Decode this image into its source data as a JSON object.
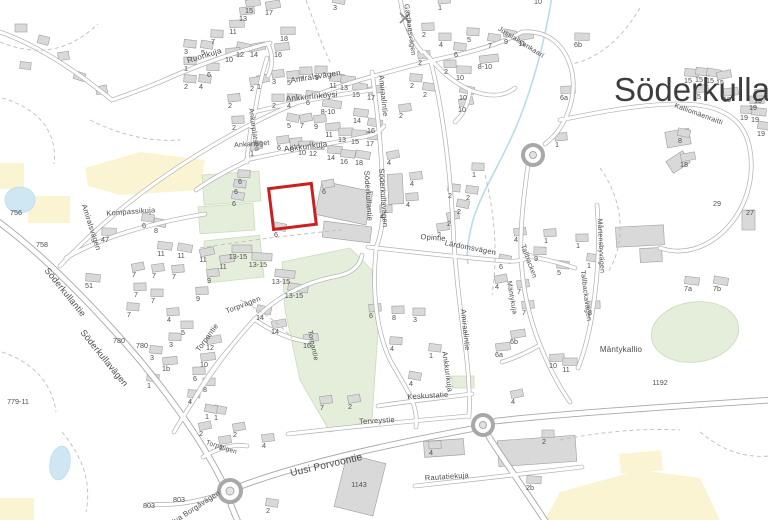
{
  "map": {
    "place_name": "Söderkulla",
    "colors": {
      "highlight": "#cc1f1f",
      "road_casing": "#b0b0b0",
      "road_fill": "#ffffff",
      "building": "#d9d9d9",
      "green_area": "#e4eedb",
      "yellow_area": "#faf4d3",
      "water": "#cfe7f2",
      "label_text": "#4a4a4a",
      "place_text": "#3d3d3d"
    },
    "street_labels": [
      {
        "t": "Ruorikuja",
        "x": 205,
        "y": 58,
        "r": -17,
        "s": 8
      },
      {
        "t": "Amiralsvägen",
        "x": 316,
        "y": 79,
        "r": -9,
        "s": 8
      },
      {
        "t": "Amiraalintie",
        "x": 381,
        "y": 96,
        "r": 84,
        "s": 7.5
      },
      {
        "t": "Ankkurinköysi",
        "x": 312,
        "y": 99,
        "r": -5,
        "s": 8
      },
      {
        "t": "Ankarplatsen",
        "x": 252,
        "y": 130,
        "r": 82,
        "s": 7
      },
      {
        "t": "Ankarlaget",
        "x": 252,
        "y": 146,
        "r": -4,
        "s": 7
      },
      {
        "t": "Ankkurikuja",
        "x": 306,
        "y": 149,
        "r": -7,
        "s": 8
      },
      {
        "t": "Gästhagsvägen",
        "x": 408,
        "y": 30,
        "r": 82,
        "s": 7
      },
      {
        "t": "Jusslaksenkaari",
        "x": 520,
        "y": 44,
        "r": 32,
        "s": 7
      },
      {
        "t": "Kalliomäenraitti",
        "x": 698,
        "y": 116,
        "r": 20,
        "s": 7
      },
      {
        "t": "Söderkullantie",
        "x": 366,
        "y": 196,
        "r": 86,
        "s": 7.5
      },
      {
        "t": "Söderkullavägen",
        "x": 381,
        "y": 198,
        "r": 86,
        "s": 7.5
      },
      {
        "t": "Opintie",
        "x": 433,
        "y": 240,
        "r": 4,
        "s": 7.5
      },
      {
        "t": "Lärdomsvägen",
        "x": 470,
        "y": 250,
        "r": 11,
        "s": 7.5
      },
      {
        "t": "Amiraalintie",
        "x": 463,
        "y": 330,
        "r": 84,
        "s": 7.5
      },
      {
        "t": "Ankkurikuja",
        "x": 445,
        "y": 372,
        "r": 82,
        "s": 7.5
      },
      {
        "t": "Kompassikuja",
        "x": 131,
        "y": 214,
        "r": -4,
        "s": 7.5
      },
      {
        "t": "Amiralsvägen",
        "x": 89,
        "y": 228,
        "r": 72,
        "s": 7.5
      },
      {
        "t": "Söderkullantie",
        "x": 63,
        "y": 294,
        "r": 51,
        "s": 9
      },
      {
        "t": "Söderkullavägen",
        "x": 102,
        "y": 360,
        "r": 51,
        "s": 9
      },
      {
        "t": "Torpvägen",
        "x": 244,
        "y": 307,
        "r": -21,
        "s": 7.5
      },
      {
        "t": "Torpantie",
        "x": 209,
        "y": 339,
        "r": -54,
        "s": 7.5
      },
      {
        "t": "Torpantie",
        "x": 311,
        "y": 346,
        "r": 78,
        "s": 7
      },
      {
        "t": "Torpstigen",
        "x": 221,
        "y": 449,
        "r": 18,
        "s": 6.5
      },
      {
        "t": "Keskustatie",
        "x": 428,
        "y": 398,
        "r": -3,
        "s": 7.5
      },
      {
        "t": "Terveystie",
        "x": 377,
        "y": 423,
        "r": -3,
        "s": 7.5
      },
      {
        "t": "Rautatiekuja",
        "x": 447,
        "y": 479,
        "r": -4,
        "s": 7.5
      },
      {
        "t": "Uusi Porvoontie",
        "x": 327,
        "y": 468,
        "r": -13,
        "s": 10
      },
      {
        "t": "Nya Borgåvägen",
        "x": 196,
        "y": 510,
        "r": -33,
        "s": 7.5
      },
      {
        "t": "Mårtensbyvägen",
        "x": 599,
        "y": 246,
        "r": 87,
        "s": 7
      },
      {
        "t": "Tallbackavägen",
        "x": 584,
        "y": 296,
        "r": 83,
        "s": 7
      },
      {
        "t": "Tallbacken",
        "x": 527,
        "y": 262,
        "r": 70,
        "s": 7
      },
      {
        "t": "Mäntykuja",
        "x": 510,
        "y": 298,
        "r": 80,
        "s": 7
      },
      {
        "t": "Mäntykallio",
        "x": 621,
        "y": 352,
        "r": 0,
        "s": 8
      }
    ],
    "house_numbers": [
      {
        "t": "15",
        "x": 249,
        "y": 13
      },
      {
        "t": "17",
        "x": 269,
        "y": 15
      },
      {
        "t": "13",
        "x": 243,
        "y": 21
      },
      {
        "t": "11",
        "x": 233,
        "y": 34
      },
      {
        "t": "18",
        "x": 284,
        "y": 41
      },
      {
        "t": "7",
        "x": 213,
        "y": 44
      },
      {
        "t": "3",
        "x": 186,
        "y": 54
      },
      {
        "t": "5",
        "x": 203,
        "y": 55
      },
      {
        "t": "12",
        "x": 240,
        "y": 57
      },
      {
        "t": "14",
        "x": 254,
        "y": 57
      },
      {
        "t": "16",
        "x": 278,
        "y": 57
      },
      {
        "t": "10",
        "x": 229,
        "y": 62
      },
      {
        "t": "1",
        "x": 186,
        "y": 71
      },
      {
        "t": "6",
        "x": 209,
        "y": 77
      },
      {
        "t": "2",
        "x": 186,
        "y": 89
      },
      {
        "t": "4",
        "x": 201,
        "y": 89
      },
      {
        "t": "3",
        "x": 335,
        "y": 10
      },
      {
        "t": "1",
        "x": 259,
        "y": 89
      },
      {
        "t": "3",
        "x": 274,
        "y": 84
      },
      {
        "t": "5",
        "x": 289,
        "y": 85
      },
      {
        "t": "7",
        "x": 302,
        "y": 81
      },
      {
        "t": "9",
        "x": 317,
        "y": 80
      },
      {
        "t": "11",
        "x": 333,
        "y": 88
      },
      {
        "t": "13",
        "x": 344,
        "y": 90
      },
      {
        "t": "15",
        "x": 356,
        "y": 97
      },
      {
        "t": "17",
        "x": 371,
        "y": 100
      },
      {
        "t": "2",
        "x": 252,
        "y": 91
      },
      {
        "t": "2",
        "x": 230,
        "y": 108
      },
      {
        "t": "2",
        "x": 234,
        "y": 130
      },
      {
        "t": "2",
        "x": 274,
        "y": 108
      },
      {
        "t": "4",
        "x": 289,
        "y": 108
      },
      {
        "t": "6",
        "x": 308,
        "y": 105
      },
      {
        "t": "8-10",
        "x": 328,
        "y": 114
      },
      {
        "t": "5",
        "x": 289,
        "y": 128
      },
      {
        "t": "7",
        "x": 302,
        "y": 128
      },
      {
        "t": "9",
        "x": 316,
        "y": 129
      },
      {
        "t": "11",
        "x": 329,
        "y": 137
      },
      {
        "t": "13",
        "x": 342,
        "y": 142
      },
      {
        "t": "15",
        "x": 355,
        "y": 144
      },
      {
        "t": "17",
        "x": 370,
        "y": 146
      },
      {
        "t": "14",
        "x": 357,
        "y": 123
      },
      {
        "t": "16",
        "x": 371,
        "y": 133
      },
      {
        "t": "1",
        "x": 252,
        "y": 156
      },
      {
        "t": "6",
        "x": 279,
        "y": 150
      },
      {
        "t": "8",
        "x": 292,
        "y": 152
      },
      {
        "t": "10",
        "x": 302,
        "y": 155
      },
      {
        "t": "12",
        "x": 313,
        "y": 156
      },
      {
        "t": "14",
        "x": 331,
        "y": 160
      },
      {
        "t": "16",
        "x": 344,
        "y": 164
      },
      {
        "t": "18",
        "x": 359,
        "y": 165
      },
      {
        "t": "4",
        "x": 389,
        "y": 165
      },
      {
        "t": "10",
        "x": 538,
        "y": 4
      },
      {
        "t": "1",
        "x": 440,
        "y": 10
      },
      {
        "t": "2",
        "x": 424,
        "y": 37
      },
      {
        "t": "4",
        "x": 441,
        "y": 47
      },
      {
        "t": "5",
        "x": 469,
        "y": 42
      },
      {
        "t": "6",
        "x": 456,
        "y": 57
      },
      {
        "t": "7",
        "x": 490,
        "y": 48
      },
      {
        "t": "9",
        "x": 506,
        "y": 44
      },
      {
        "t": "11",
        "x": 522,
        "y": 46
      },
      {
        "t": "8-10",
        "x": 485,
        "y": 69
      },
      {
        "t": "2",
        "x": 420,
        "y": 65
      },
      {
        "t": "2",
        "x": 446,
        "y": 74
      },
      {
        "t": "10",
        "x": 460,
        "y": 80
      },
      {
        "t": "2",
        "x": 412,
        "y": 88
      },
      {
        "t": "2",
        "x": 425,
        "y": 97
      },
      {
        "t": "10",
        "x": 463,
        "y": 100
      },
      {
        "t": "10",
        "x": 462,
        "y": 112
      },
      {
        "t": "2",
        "x": 401,
        "y": 118
      },
      {
        "t": "1",
        "x": 557,
        "y": 147
      },
      {
        "t": "6a",
        "x": 564,
        "y": 100
      },
      {
        "t": "6b",
        "x": 578,
        "y": 47
      },
      {
        "t": "15",
        "x": 688,
        "y": 83
      },
      {
        "t": "15",
        "x": 699,
        "y": 82
      },
      {
        "t": "15",
        "x": 710,
        "y": 83
      },
      {
        "t": "15",
        "x": 720,
        "y": 85
      },
      {
        "t": "15",
        "x": 697,
        "y": 99
      },
      {
        "t": "15",
        "x": 727,
        "y": 102
      },
      {
        "t": "19",
        "x": 758,
        "y": 103
      },
      {
        "t": "19",
        "x": 753,
        "y": 110
      },
      {
        "t": "19",
        "x": 744,
        "y": 120
      },
      {
        "t": "19",
        "x": 755,
        "y": 122
      },
      {
        "t": "19",
        "x": 761,
        "y": 136
      },
      {
        "t": "8",
        "x": 680,
        "y": 143
      },
      {
        "t": "18",
        "x": 684,
        "y": 167
      },
      {
        "t": "4",
        "x": 516,
        "y": 242
      },
      {
        "t": "1",
        "x": 546,
        "y": 243
      },
      {
        "t": "1",
        "x": 578,
        "y": 248
      },
      {
        "t": "9",
        "x": 536,
        "y": 261
      },
      {
        "t": "5",
        "x": 559,
        "y": 275
      },
      {
        "t": "1",
        "x": 589,
        "y": 268
      },
      {
        "t": "6",
        "x": 501,
        "y": 269
      },
      {
        "t": "4",
        "x": 497,
        "y": 289
      },
      {
        "t": "7",
        "x": 519,
        "y": 294
      },
      {
        "t": "7",
        "x": 524,
        "y": 315
      },
      {
        "t": "8",
        "x": 590,
        "y": 315
      },
      {
        "t": "29",
        "x": 717,
        "y": 206
      },
      {
        "t": "27",
        "x": 750,
        "y": 215
      },
      {
        "t": "7a",
        "x": 688,
        "y": 291
      },
      {
        "t": "7b",
        "x": 717,
        "y": 291
      },
      {
        "t": "1192",
        "x": 660,
        "y": 385
      },
      {
        "t": "6b",
        "x": 514,
        "y": 344
      },
      {
        "t": "6a",
        "x": 499,
        "y": 357
      },
      {
        "t": "10",
        "x": 553,
        "y": 368
      },
      {
        "t": "11",
        "x": 566,
        "y": 372
      },
      {
        "t": "6",
        "x": 240,
        "y": 184
      },
      {
        "t": "6",
        "x": 236,
        "y": 194
      },
      {
        "t": "6",
        "x": 234,
        "y": 206
      },
      {
        "t": "6",
        "x": 276,
        "y": 237
      },
      {
        "t": "6",
        "x": 324,
        "y": 194
      },
      {
        "t": "4",
        "x": 412,
        "y": 186
      },
      {
        "t": "4",
        "x": 408,
        "y": 207
      },
      {
        "t": "4",
        "x": 382,
        "y": 219
      },
      {
        "t": "1",
        "x": 474,
        "y": 177
      },
      {
        "t": "2",
        "x": 450,
        "y": 198
      },
      {
        "t": "2",
        "x": 468,
        "y": 200
      },
      {
        "t": "2",
        "x": 459,
        "y": 214
      },
      {
        "t": "2",
        "x": 449,
        "y": 226
      },
      {
        "t": "2",
        "x": 439,
        "y": 237
      },
      {
        "t": "6",
        "x": 371,
        "y": 318
      },
      {
        "t": "8",
        "x": 394,
        "y": 320
      },
      {
        "t": "3",
        "x": 415,
        "y": 322
      },
      {
        "t": "4",
        "x": 392,
        "y": 351
      },
      {
        "t": "1",
        "x": 431,
        "y": 358
      },
      {
        "t": "4",
        "x": 411,
        "y": 386
      },
      {
        "t": "4",
        "x": 513,
        "y": 404
      },
      {
        "t": "2",
        "x": 350,
        "y": 409
      },
      {
        "t": "7",
        "x": 322,
        "y": 410
      },
      {
        "t": "4",
        "x": 431,
        "y": 455
      },
      {
        "t": "2",
        "x": 544,
        "y": 444
      },
      {
        "t": "2b",
        "x": 530,
        "y": 490
      },
      {
        "t": "1143",
        "x": 359,
        "y": 487
      },
      {
        "t": "2",
        "x": 268,
        "y": 513
      },
      {
        "t": "1",
        "x": 216,
        "y": 420
      },
      {
        "t": "2",
        "x": 235,
        "y": 437
      },
      {
        "t": "4",
        "x": 264,
        "y": 448
      },
      {
        "t": "756",
        "x": 16,
        "y": 215
      },
      {
        "t": "758",
        "x": 42,
        "y": 247
      },
      {
        "t": "47",
        "x": 105,
        "y": 242
      },
      {
        "t": "51",
        "x": 89,
        "y": 288
      },
      {
        "t": "6",
        "x": 144,
        "y": 228
      },
      {
        "t": "8",
        "x": 156,
        "y": 233
      },
      {
        "t": "7",
        "x": 134,
        "y": 277
      },
      {
        "t": "7",
        "x": 154,
        "y": 278
      },
      {
        "t": "7",
        "x": 174,
        "y": 279
      },
      {
        "t": "7",
        "x": 136,
        "y": 297
      },
      {
        "t": "7",
        "x": 153,
        "y": 303
      },
      {
        "t": "7",
        "x": 129,
        "y": 317
      },
      {
        "t": "11",
        "x": 161,
        "y": 256
      },
      {
        "t": "11",
        "x": 181,
        "y": 258
      },
      {
        "t": "11",
        "x": 203,
        "y": 262
      },
      {
        "t": "11",
        "x": 223,
        "y": 269
      },
      {
        "t": "9",
        "x": 209,
        "y": 283
      },
      {
        "t": "9",
        "x": 198,
        "y": 301
      },
      {
        "t": "13-15",
        "x": 238,
        "y": 259
      },
      {
        "t": "13-15",
        "x": 258,
        "y": 267
      },
      {
        "t": "13-15",
        "x": 281,
        "y": 284
      },
      {
        "t": "13-15",
        "x": 294,
        "y": 298
      },
      {
        "t": "14",
        "x": 260,
        "y": 320
      },
      {
        "t": "14",
        "x": 275,
        "y": 334
      },
      {
        "t": "16",
        "x": 307,
        "y": 348
      },
      {
        "t": "4",
        "x": 169,
        "y": 322
      },
      {
        "t": "5",
        "x": 183,
        "y": 335
      },
      {
        "t": "3",
        "x": 171,
        "y": 347
      },
      {
        "t": "3",
        "x": 152,
        "y": 360
      },
      {
        "t": "780",
        "x": 119,
        "y": 343
      },
      {
        "t": "780",
        "x": 142,
        "y": 348
      },
      {
        "t": "12",
        "x": 210,
        "y": 350
      },
      {
        "t": "10",
        "x": 204,
        "y": 367
      },
      {
        "t": "1b",
        "x": 166,
        "y": 371
      },
      {
        "t": "6",
        "x": 195,
        "y": 381
      },
      {
        "t": "8",
        "x": 205,
        "y": 392
      },
      {
        "t": "4",
        "x": 190,
        "y": 404
      },
      {
        "t": "1",
        "x": 149,
        "y": 388
      },
      {
        "t": "1",
        "x": 207,
        "y": 419
      },
      {
        "t": "2",
        "x": 201,
        "y": 436
      },
      {
        "t": "2",
        "x": 221,
        "y": 450
      },
      {
        "t": "779-11",
        "x": 18,
        "y": 404
      },
      {
        "t": "803",
        "x": 149,
        "y": 508
      },
      {
        "t": "803",
        "x": 179,
        "y": 502
      }
    ]
  }
}
